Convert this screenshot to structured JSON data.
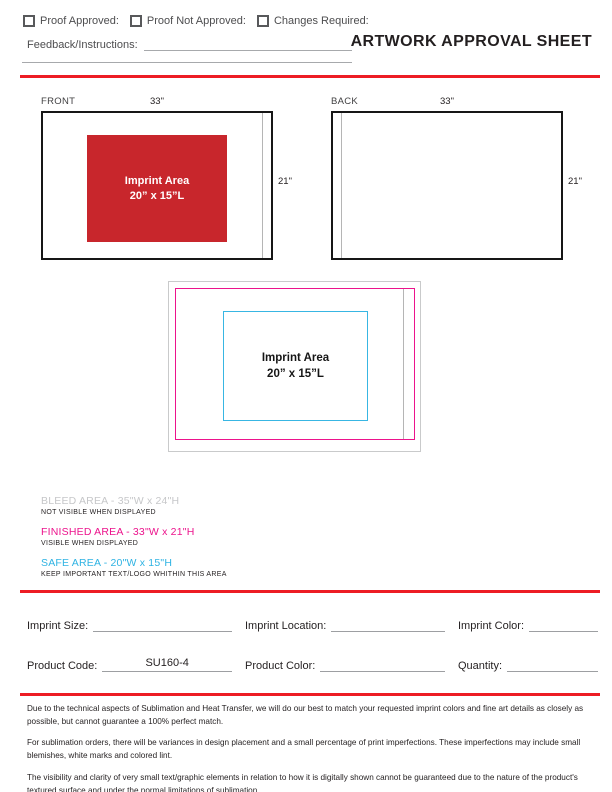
{
  "header": {
    "title": "ARTWORK APPROVAL SHEET",
    "checkboxes": [
      {
        "label": "Proof Approved:"
      },
      {
        "label": "Proof Not Approved:"
      },
      {
        "label": "Changes Required:"
      }
    ],
    "feedback_label": "Feedback/Instructions:"
  },
  "panels": {
    "front": {
      "label": "FRONT",
      "width_dim": "33\"",
      "height_dim": "21\"",
      "imprint_line1": "Imprint Area",
      "imprint_line2": "20” x 15”L"
    },
    "back": {
      "label": "BACK",
      "width_dim": "33\"",
      "height_dim": "21\""
    }
  },
  "diagram": {
    "imprint_line1": "Imprint Area",
    "imprint_line2": "20” x 15”L"
  },
  "legend": [
    {
      "title": "BLEED AREA - 35\"W x 24\"H",
      "subtitle": "NOT VISIBLE WHEN DISPLAYED",
      "color": "#c6c7c9"
    },
    {
      "title": "FINISHED AREA - 33\"W x 21\"H",
      "subtitle": "VISIBLE WHEN DISPLAYED",
      "color": "#ec138c"
    },
    {
      "title": "SAFE AREA - 20\"W x 15\"H",
      "subtitle": "KEEP IMPORTANT TEXT/LOGO WHITHIN THIS AREA",
      "color": "#2fb3e3"
    }
  ],
  "form": {
    "fields": [
      {
        "label": "Imprint Size:",
        "value": ""
      },
      {
        "label": "Imprint Location:",
        "value": ""
      },
      {
        "label": "Imprint Color:",
        "value": ""
      },
      {
        "label": "Product Code:",
        "value": "SU160-4"
      },
      {
        "label": "Product Color:",
        "value": ""
      },
      {
        "label": "Quantity:",
        "value": ""
      }
    ]
  },
  "disclaimer": {
    "paragraphs": [
      "Due to the technical aspects of Sublimation and Heat Transfer, we will do our best to match your requested imprint colors and fine art details as closely as possible, but cannot guarantee a 100% perfect match.",
      "For sublimation orders, there will be variances in design placement and a small percentage of print imperfections. These imperfections may include small blemishes, white marks and colored lint.",
      "The visibility and clarity of very small text/graphic elements in relation to how it is digitally shown cannot be guaranteed due to the nature of the product's textured surface and under the normal limitations of sublimation."
    ]
  },
  "colors": {
    "accent_red": "#ed1c24",
    "imprint_red": "#c8262c",
    "bleed_gray": "#c6c7c9",
    "finished_magenta": "#ec138c",
    "safe_cyan": "#2fb3e3"
  }
}
